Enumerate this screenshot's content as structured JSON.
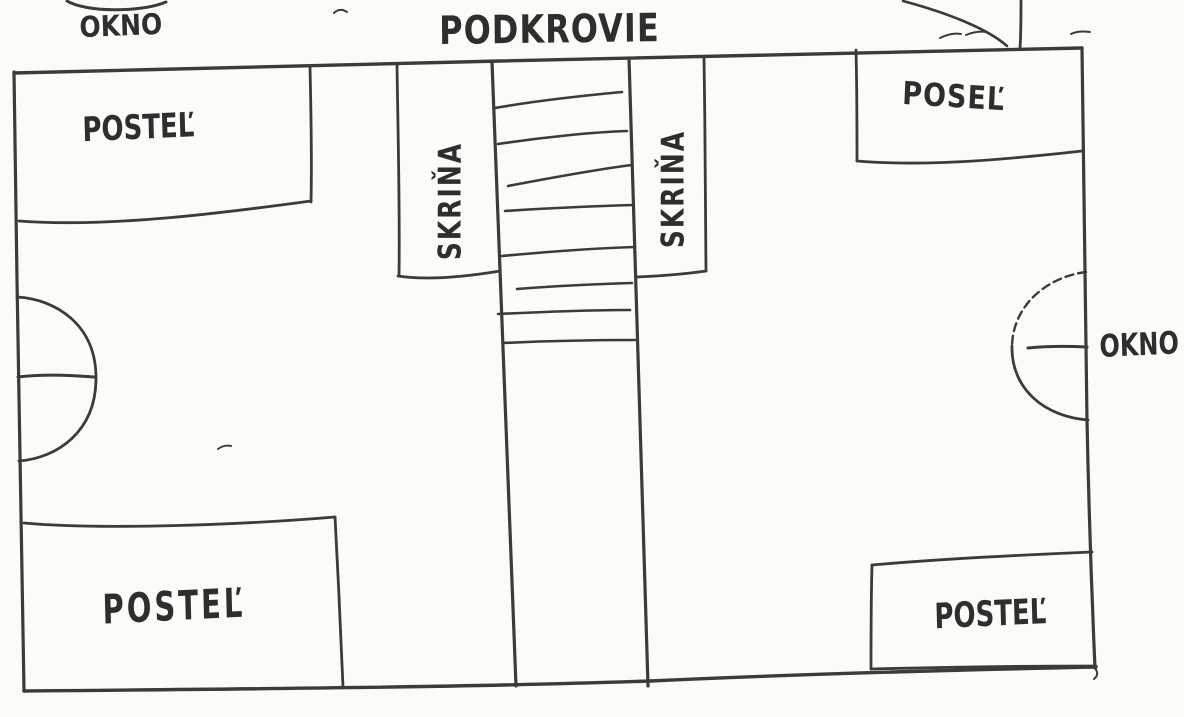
{
  "palette": {
    "ink": "#3b3b3b",
    "paper": "#fbfbf8",
    "text": "#2e2e2e"
  },
  "plan": {
    "title": "PODKROVIE",
    "windows": {
      "top_label": "OKNO",
      "right_label": "OKNO"
    },
    "beds": {
      "top_left_label": "POSTEĽ",
      "top_right_label": "POSEĽ",
      "bottom_left_label": "POSTEĽ",
      "bottom_right_label": "POSTEĽ"
    },
    "wardrobes": {
      "left_label": "SKRIŇA",
      "right_label": "SKRIŇA"
    }
  }
}
